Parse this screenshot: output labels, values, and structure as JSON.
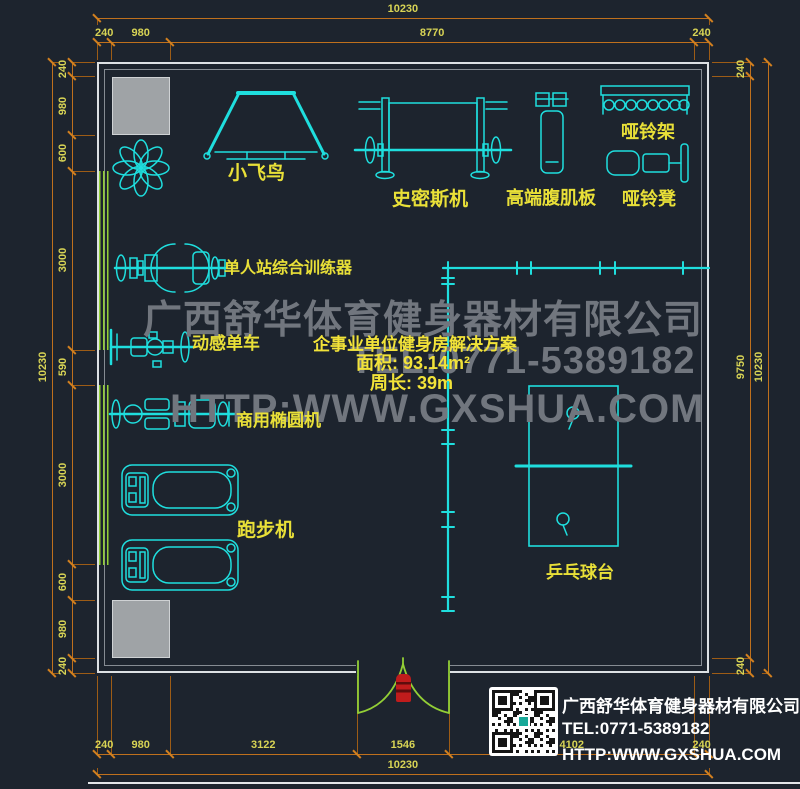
{
  "colors": {
    "background": "#1d242e",
    "wall": "#dde1e4",
    "wall_inner": "#868c93",
    "pillar": "#9fa3a6",
    "dimension_line": "#bf701d",
    "dimension_text": "#d8d455",
    "equipment_line": "#1fdede",
    "label_text": "#e9e038",
    "mirror_and_door": "#93cf36",
    "door_marker": "#c01c1c",
    "watermark": "#71767e",
    "logo_text": "#ffffff"
  },
  "dims": {
    "top_overall": [
      "10230"
    ],
    "top_segments": [
      "240",
      "980",
      "8770",
      "240"
    ],
    "bottom_segments": [
      "240",
      "980",
      "3122",
      "1546",
      "4102",
      "240"
    ],
    "bottom_overall": [
      "10230"
    ],
    "left_segments": [
      "240",
      "980",
      "600",
      "3000",
      "590",
      "3000",
      "600",
      "980",
      "240"
    ],
    "left_overall": [
      "10230"
    ],
    "right_segments": [
      "240",
      "9750",
      "240"
    ],
    "right_overall": [
      "10230"
    ]
  },
  "equipment": [
    {
      "id": "butterfly-machine",
      "label": "小飞鸟"
    },
    {
      "id": "smith-machine",
      "label": "史密斯机"
    },
    {
      "id": "ab-board",
      "label": "高端腹肌板"
    },
    {
      "id": "dumbbell-rack",
      "label": "哑铃架"
    },
    {
      "id": "dumbbell-bench",
      "label": "哑铃凳"
    },
    {
      "id": "single-station-trainer",
      "label": "单人站综合训练器"
    },
    {
      "id": "spin-bike",
      "label": "动感单车"
    },
    {
      "id": "commercial-elliptical",
      "label": "商用椭圆机"
    },
    {
      "id": "treadmill",
      "label": "跑步机"
    },
    {
      "id": "ping-pong-table",
      "label": "乒乓球台"
    }
  ],
  "watermark": {
    "company": "广西舒华体育健身器材有限公司",
    "tel": "TEL:0771-5389182",
    "web": "HTTP:WWW.GXSHUA.COM"
  },
  "info": {
    "title": "企事业单位健身房解决方案",
    "area": "面积: 93.14m²",
    "perimeter": "周长: 39m"
  },
  "logo": {
    "company": "广西舒华体育健身器材有限公司",
    "tel": "TEL:0771-5389182",
    "web": "HTTP:WWW.GXSHUA.COM"
  }
}
